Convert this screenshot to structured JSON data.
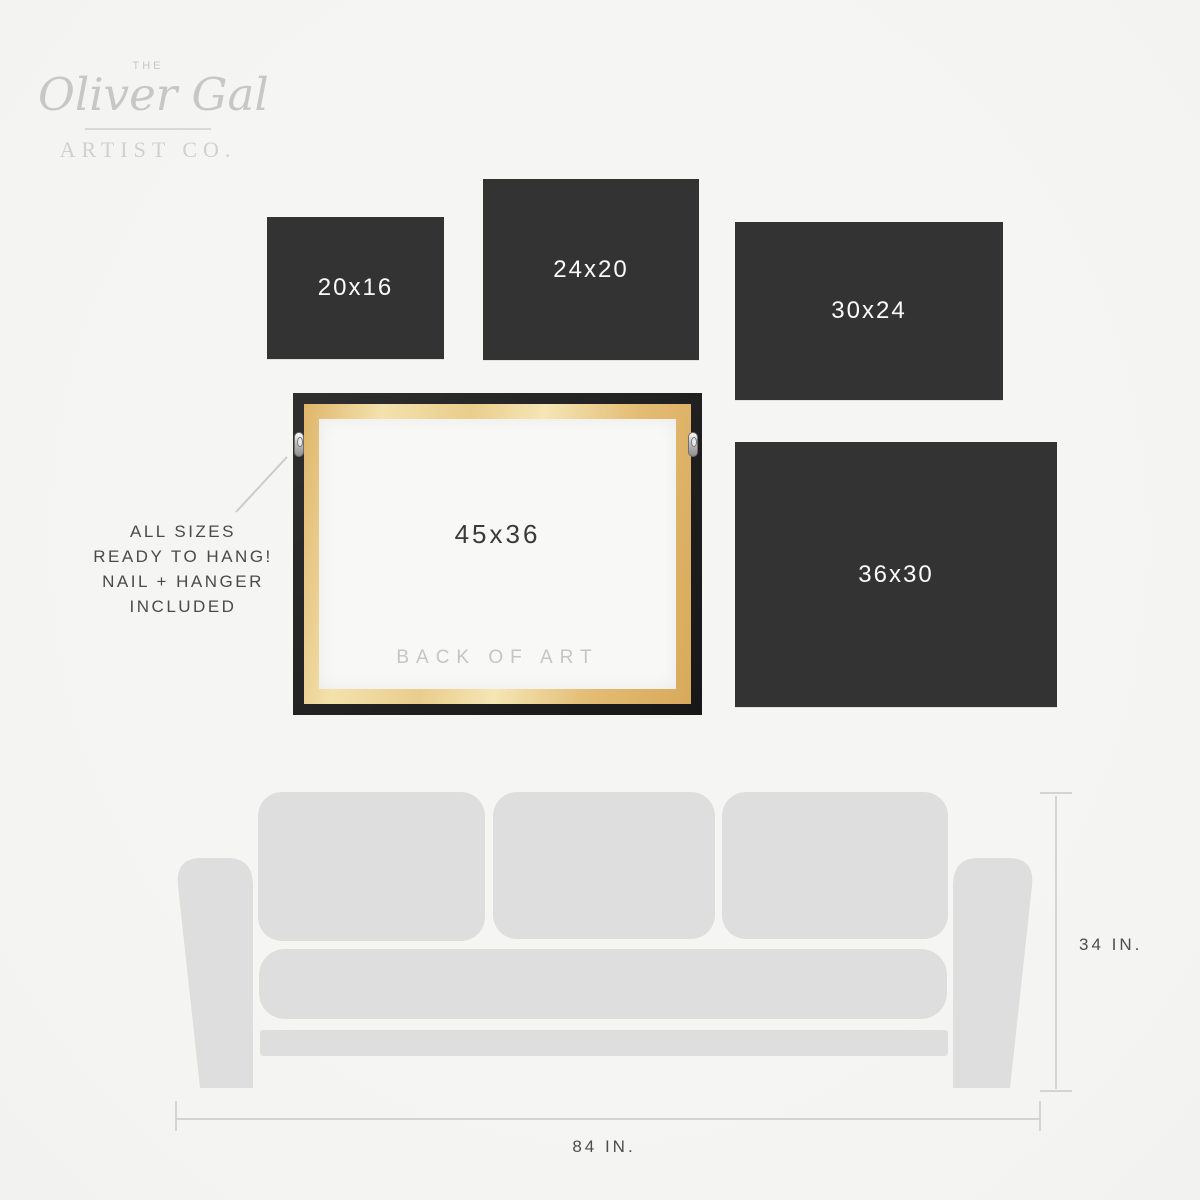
{
  "logo": {
    "the": "THE",
    "name": "Oliver Gal",
    "subtitle": "ARTIST CO."
  },
  "size_panels": [
    {
      "label": "20x16"
    },
    {
      "label": "24x20"
    },
    {
      "label": "30x24"
    },
    {
      "label": "36x30"
    }
  ],
  "featured_frame": {
    "label": "45x36",
    "caption": "BACK OF ART"
  },
  "hanging_note": {
    "line1": "ALL SIZES",
    "line2": "READY TO HANG!",
    "line3": "NAIL + HANGER",
    "line4": "INCLUDED"
  },
  "couch_dimensions": {
    "height": "34 IN.",
    "width": "84 IN."
  },
  "colors": {
    "background": "#f5f5f4",
    "panel_dark": "#333333",
    "panel_text": "#fafafa",
    "couch_gray": "#dedede",
    "logo_gray": "#c7c7c7",
    "note_text": "#4a4a4a",
    "dim_line": "#c9c9c9",
    "dim_text": "#4d4d4d",
    "caption_gray": "#c5c5c5",
    "frame_black": "#1f1f1f",
    "wood_tan": "#e8c77f",
    "canvas_white": "#f8f8f6"
  }
}
